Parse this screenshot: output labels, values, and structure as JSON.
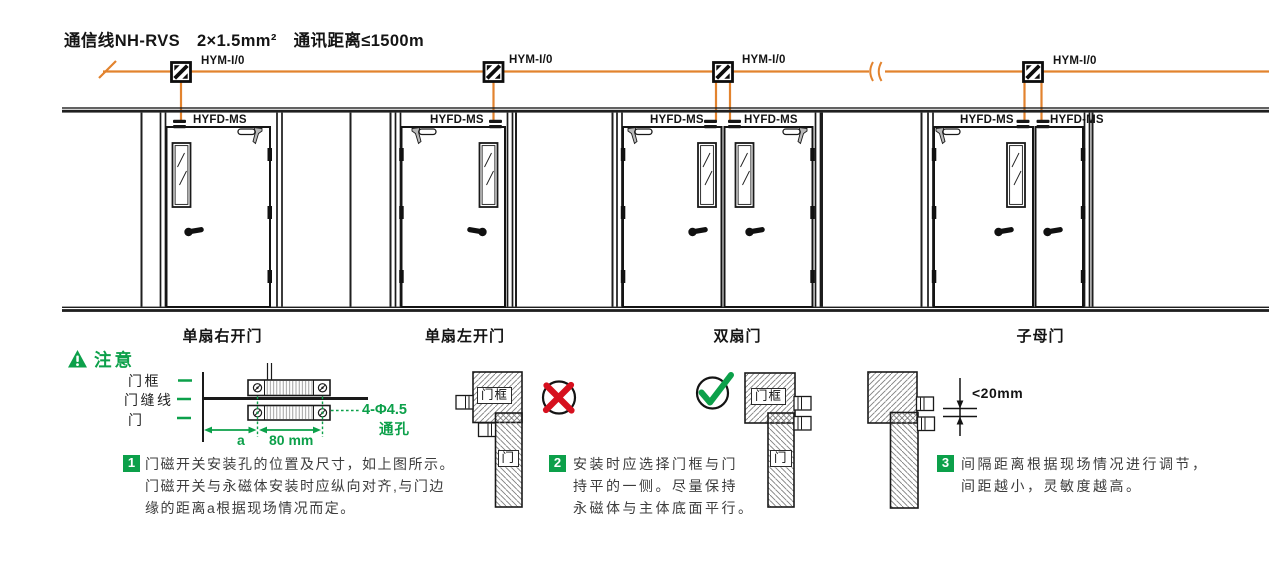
{
  "header": {
    "comm_spec": "通信线NH-RVS　2×1.5mm²　通讯距离≤1500m"
  },
  "topology": {
    "modules": [
      "HYM-I/0",
      "HYM-I/0",
      "HYM-I/0",
      "HYM-I/0"
    ],
    "sensors": [
      "HYFD-MS",
      "HYFD-MS",
      "HYFD-MS",
      "HYFD-MS",
      "HYFD-MS",
      "HYFD-MS"
    ]
  },
  "doors": [
    {
      "label": "单扇右开门"
    },
    {
      "label": "单扇左开门"
    },
    {
      "label": "双扇门"
    },
    {
      "label": "子母门"
    }
  ],
  "notice": {
    "title": "注意",
    "detail": {
      "frame_label": "门框",
      "gap_line_label": "门缝线",
      "door_label": "门",
      "dim_a": "a",
      "dim_width": "80 mm",
      "holes_line1": "4-Φ4.5",
      "holes_line2": "通孔"
    },
    "wrong_diagram": {
      "frame_label": "门框",
      "door_label": "门"
    },
    "correct_diagram": {
      "frame_label": "门框",
      "door_label": "门"
    },
    "gap_diagram": {
      "dim": "<20mm"
    },
    "items": [
      {
        "num": "1",
        "lines": [
          "门磁开关安装孔的位置及尺寸，如上图所示。",
          "门磁开关与永磁体安装时应纵向对齐,与门边",
          "缘的距离a根据现场情况而定。"
        ]
      },
      {
        "num": "2",
        "lines": [
          "安装时应选择门框与门",
          "持平的一侧。尽量保持",
          "永磁体与主体底面平行。"
        ]
      },
      {
        "num": "3",
        "lines": [
          "间隔距离根据现场情况进行调节，",
          "间距越小，灵敏度越高。"
        ]
      }
    ]
  },
  "colors": {
    "orange": "#E2832E",
    "green": "#0CA04A",
    "red": "#D6101E",
    "line": "#1A1A1A"
  }
}
